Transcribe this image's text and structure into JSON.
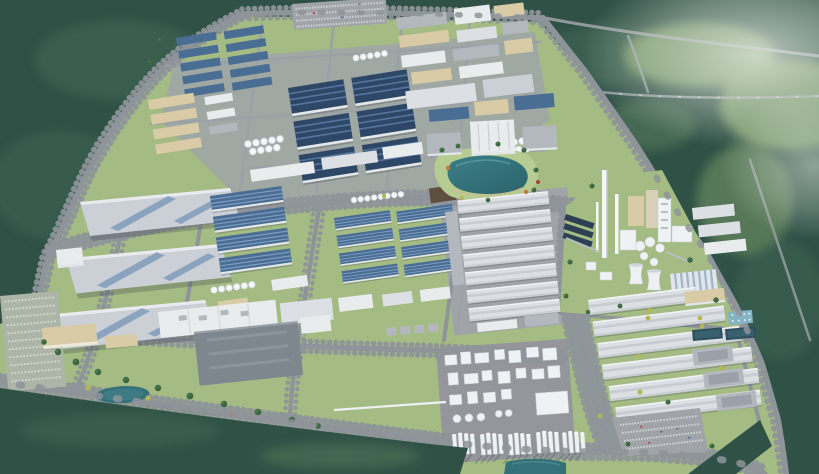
{
  "scene": {
    "subject": "Aerial 3D rendering of a large industrial park master plan surrounded by dense forest",
    "view": "oblique bird's-eye perspective, hazy daylight",
    "features": {
      "forest": [
        "dense dark forest across the north and east",
        "lighter hazy clearings at top right",
        "forest belt along the south-west edge",
        "forest wedge in the bottom-right corner"
      ],
      "water": [
        "central landscaped lake with teal water",
        "small pond in the south lawn",
        "dark wastewater treatment basins",
        "light-blue aeration pool grid",
        "retention pond at the south edge"
      ],
      "districts": [
        {
          "name": "north-factory-district",
          "contents": "rows of small blue-roof workshops, tan utility buildings, visitor parking full of cars, white storage tank groups"
        },
        {
          "name": "navy-warehouse-block",
          "contents": "six large navy-blue warehouses in a 2x3 grid with light panel stripes"
        },
        {
          "name": "west-mega-warehouses",
          "contents": "three extra-large light-grey warehouses with diagonal skylight ridges"
        },
        {
          "name": "west-parking-strip",
          "contents": "long striped surface parking lot"
        },
        {
          "name": "central-blue-warehouse-blocks",
          "contents": "stacked long blue-roof workshops with white tank rows and a dark brown utility building"
        },
        {
          "name": "lakefront-campus",
          "contents": "white administrative buildings facing the lake with orange and red accent trees"
        },
        {
          "name": "white-warehouse-district",
          "contents": "seven rows of white ribbed warehouses on a concrete pad"
        },
        {
          "name": "chemical-plant",
          "contents": "dense white process plant with rows of tall distillation columns on a grey pad and a white pipe bridge"
        },
        {
          "name": "cement-power-plant",
          "contents": "tall white chimney, preheater tower, silos, two cooling towers, dark solar panel rows, striped-roof hall"
        },
        {
          "name": "east-warehouse-district",
          "contents": "six long white warehouse rows, grey flat-roof plants, treatment pools, triangular staff parking with colored cars"
        },
        {
          "name": "south-lawn-campus",
          "contents": "white factory with rooftop units, large dark-grey plant, tan office buildings, tree-filled lawn"
        }
      ],
      "roads": "tree-lined boulevard grid with a curving perimeter road and thin rural roads crossing the forest"
    },
    "counts": {
      "mega_warehouses_west": 3,
      "navy_warehouses": 6,
      "white_warehouse_rows_center": 7,
      "east_warehouse_rows": 6,
      "cooling_towers": 2,
      "treatment_basins": 2
    }
  },
  "palette": {
    "forest_dark": "#2f5146",
    "forest_mid": "#3e6452",
    "forest_light": "#55795a",
    "clearing": "#7fa069",
    "lawn": "#a4bc83",
    "lawn_light": "#b6cc92",
    "lawn_dark": "#8fae72",
    "road": "#8e9499",
    "road_minor": "#9ba1a6",
    "pad": "#a0a4a9",
    "pad_dark": "#94969b",
    "navy_roof": "#2f4766",
    "navy_stripe": "#54759e",
    "blue_roof": "#4a6d94",
    "blue_stripe": "#7f9dc3",
    "gray_roof": "#cbd0d6",
    "ridge_blue": "#8ba3bf",
    "white_roof": "#e9eced",
    "ribbed": "#dcdfe3",
    "mid_gray": "#b2b8be",
    "tan_wall": "#c9b88e",
    "tan_roof": "#d8cba6",
    "brown_roof": "#5e4f3f",
    "tank_white": "#eff2f4",
    "water": "#347179",
    "water_light": "#5293a0",
    "pool_dark": "#2e4f5e",
    "pool_light": "#83b4c6",
    "tree": "#3a6540",
    "tree_dark": "#2e5336",
    "tree_yellow": "#b5b855",
    "tree_orange": "#c07a3e",
    "tree_red": "#a34631",
    "dark_building": "#7e868e",
    "chimney": "#f4f6f7",
    "panel_dark": "#2d3f53",
    "shadow": "#39424d",
    "car_light": "#d2d6d9",
    "car_dark": "#70777e",
    "car_red": "#b04b3c",
    "car_blue": "#4a6fa5"
  }
}
